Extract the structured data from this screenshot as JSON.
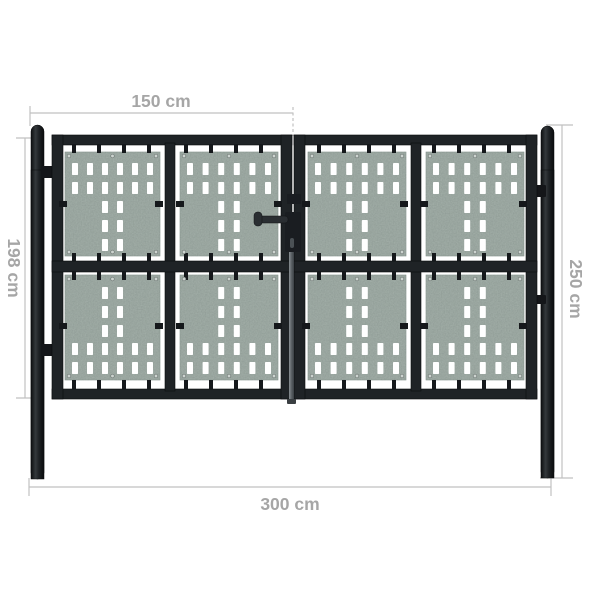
{
  "page": {
    "type": "product dimension diagram",
    "subject": "Black double-door garden fence gate with perforated metal panels",
    "background": "#ffffff"
  },
  "annotations": {
    "top_width_label": "150 cm",
    "left_height_label": "198 cm",
    "right_height_label": "250 cm",
    "bottom_width_label": "300 cm"
  },
  "style": {
    "dimension_line_color": "#c1c1c1",
    "dimension_text_color": "#a6a6a6",
    "frame_color": "#1f2326",
    "clip_color": "#15181b",
    "hinge_color": "#141619",
    "panel_color": "#a7b4ad",
    "panel_edge_color": "#93a19b",
    "hole_color": "#ffffff",
    "handle_color": "#2a2e32",
    "lock_color": "#1a1d21",
    "keyhole_color": "#4b5155",
    "drop_rod_color": "#63696d",
    "screw_color": "#cdd4d0",
    "screw_ring_color": "#707a76"
  }
}
